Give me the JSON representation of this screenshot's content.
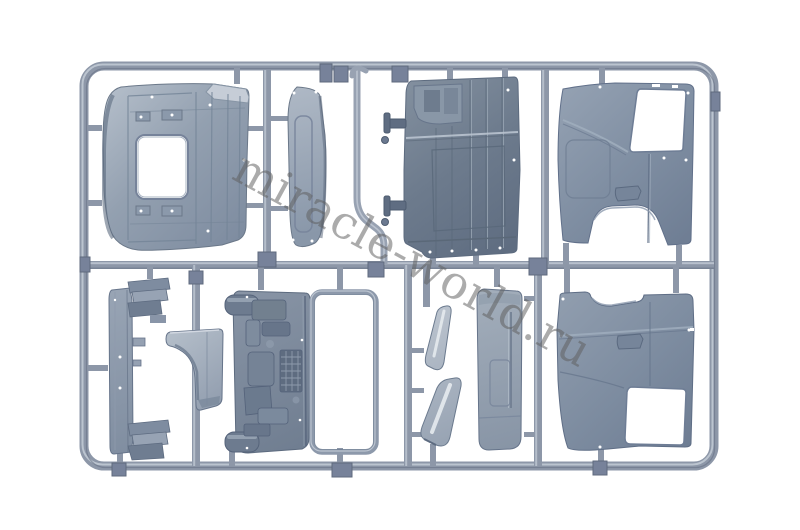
{
  "meta": {
    "type": "product-photo",
    "subject": "injection-molded plastic model kit sprue with truck cab body panels",
    "background": "#ffffff"
  },
  "watermark": {
    "text": "miracle-world.ru",
    "color": "#5f5f5f",
    "opacity": "0.52",
    "rotation_deg": 28.5
  },
  "colors": {
    "runner": "#8d97a8",
    "runner_highlight": "#c3cbd6",
    "runner_shadow": "#5f6a7d",
    "junction_tab": "#77829a",
    "plastic_lightest": "#c0c8d2",
    "plastic_light": "#a6b1c0",
    "plastic_mid": "#8d9aac",
    "plastic_dark": "#6d7b8d",
    "plastic_deep": "#5f6d81",
    "cutout_white": "#ffffff",
    "edge_line": "#5d6b7f"
  },
  "sprue": {
    "frame_shape": "rounded rectangle runner frame",
    "parts": [
      {
        "name": "cab-roof-panel",
        "location": "top-left",
        "feature": "rectangular sunroof opening and wind deflector edge"
      },
      {
        "name": "lower-front-panel",
        "location": "top-center-left",
        "feature": "curved narrow panel with recessed border"
      },
      {
        "name": "trim-strip",
        "location": "top-center",
        "feature": "thin strip with curved lower runner elbow"
      },
      {
        "name": "cab-rear-panel",
        "location": "top-center-right",
        "feature": "two hinge pins on left edge, vertical ribs"
      },
      {
        "name": "cab-side-panel-right",
        "location": "top-right",
        "feature": "door window opening and wheel-arch cutout"
      },
      {
        "name": "side-step-frame",
        "location": "bottom-left",
        "feature": "vertical spine with step brackets top and bottom"
      },
      {
        "name": "engine-tunnel-cover",
        "location": "bottom-center-left",
        "feature": "pedestal shape with concave web"
      },
      {
        "name": "cab-floor-assembly",
        "location": "bottom-center",
        "feature": "dense molded detail, vent grille, round bosses"
      },
      {
        "name": "window-frame",
        "location": "bottom-center",
        "feature": "thin open rectangle"
      },
      {
        "name": "deflector-blade-upper",
        "location": "bottom-center-right",
        "feature": "small curved blade"
      },
      {
        "name": "deflector-blade-lower",
        "location": "bottom-center-right",
        "feature": "larger curved blade"
      },
      {
        "name": "door-inner-panel",
        "location": "bottom-center-right",
        "feature": "flat rounded panel with recess lines"
      },
      {
        "name": "cab-side-panel-left",
        "location": "bottom-right",
        "feature": "door window opening and wheel-arch notch on top edge"
      }
    ]
  }
}
